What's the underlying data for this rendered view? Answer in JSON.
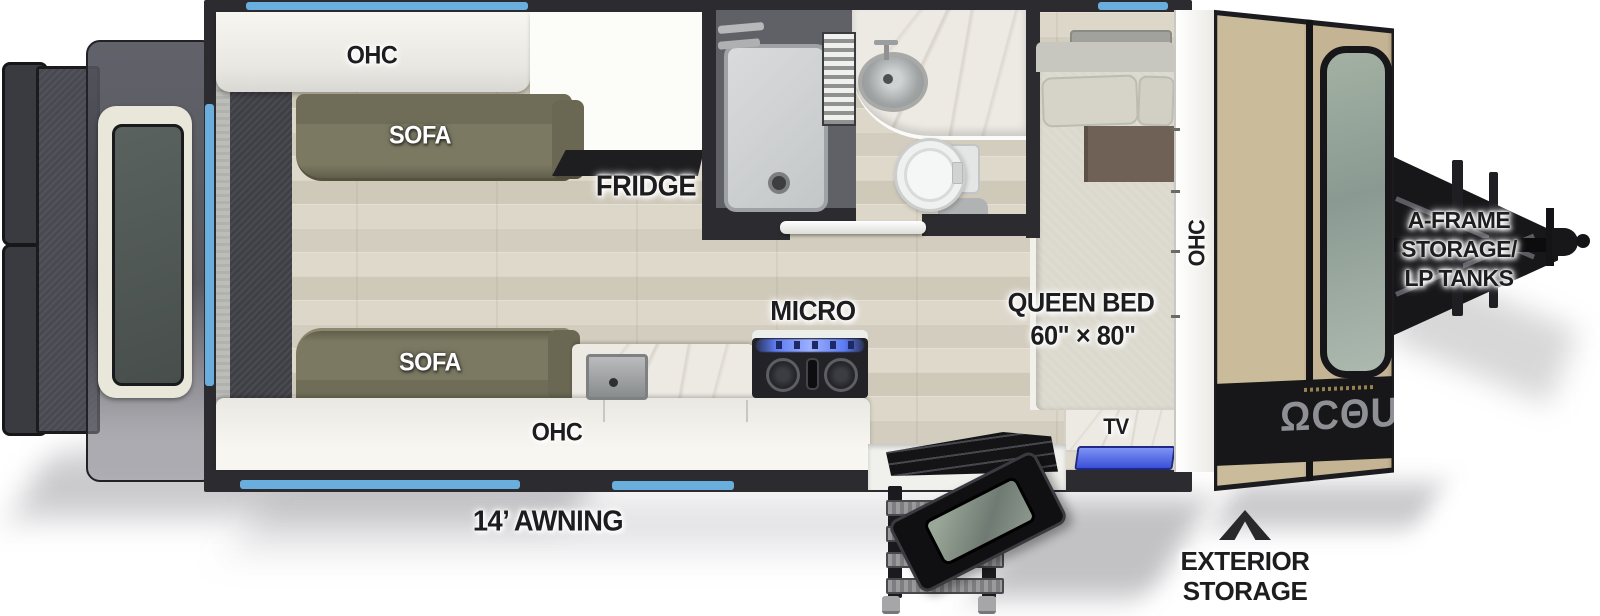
{
  "meta": {
    "subject": "Travel trailer floor plan, top-down cutaway view",
    "canvas": {
      "width": 1600,
      "height": 616
    }
  },
  "labels": {
    "ohc_top": "OHC",
    "sofa_top": "SOFA",
    "fridge": "FRIDGE",
    "micro": "MICRO",
    "queen_bed": "QUEEN BED",
    "queen_bed_size": "60\" × 80\"",
    "ohc_front": "OHC",
    "sofa_bottom": "SOFA",
    "ohc_bottom": "OHC",
    "tv": "TV",
    "awning": "14’ AWNING",
    "aframe1": "A-FRAME",
    "aframe2": "STORAGE/",
    "aframe3": "LP TANKS",
    "exterior1": "EXTERIOR",
    "exterior2": "STORAGE",
    "cap_glyphs": "ΩCΘU"
  },
  "features": {
    "bed": {
      "type": "QUEEN BED",
      "size": "60\" × 80\""
    },
    "awning_length": "14’",
    "storage_front": "A-FRAME STORAGE/ LP TANKS",
    "storage_side": "EXTERIOR STORAGE",
    "cabinets": [
      "OHC",
      "OHC",
      "OHC"
    ],
    "seating": [
      "SOFA",
      "SOFA"
    ],
    "appliances": [
      "FRIDGE",
      "MICRO",
      "TV"
    ]
  },
  "colors": {
    "accent_blue": "#6aaede",
    "sofa_olive": "#7b7962",
    "cap_tan": "#c4b494",
    "tv_blue": "#3b4fd8",
    "wall_dark": "#2c2c30",
    "label_ink": "#1d1d1f",
    "floor_wood": "#d8d3c5",
    "stove_glow_blue": "#4a63e8"
  }
}
